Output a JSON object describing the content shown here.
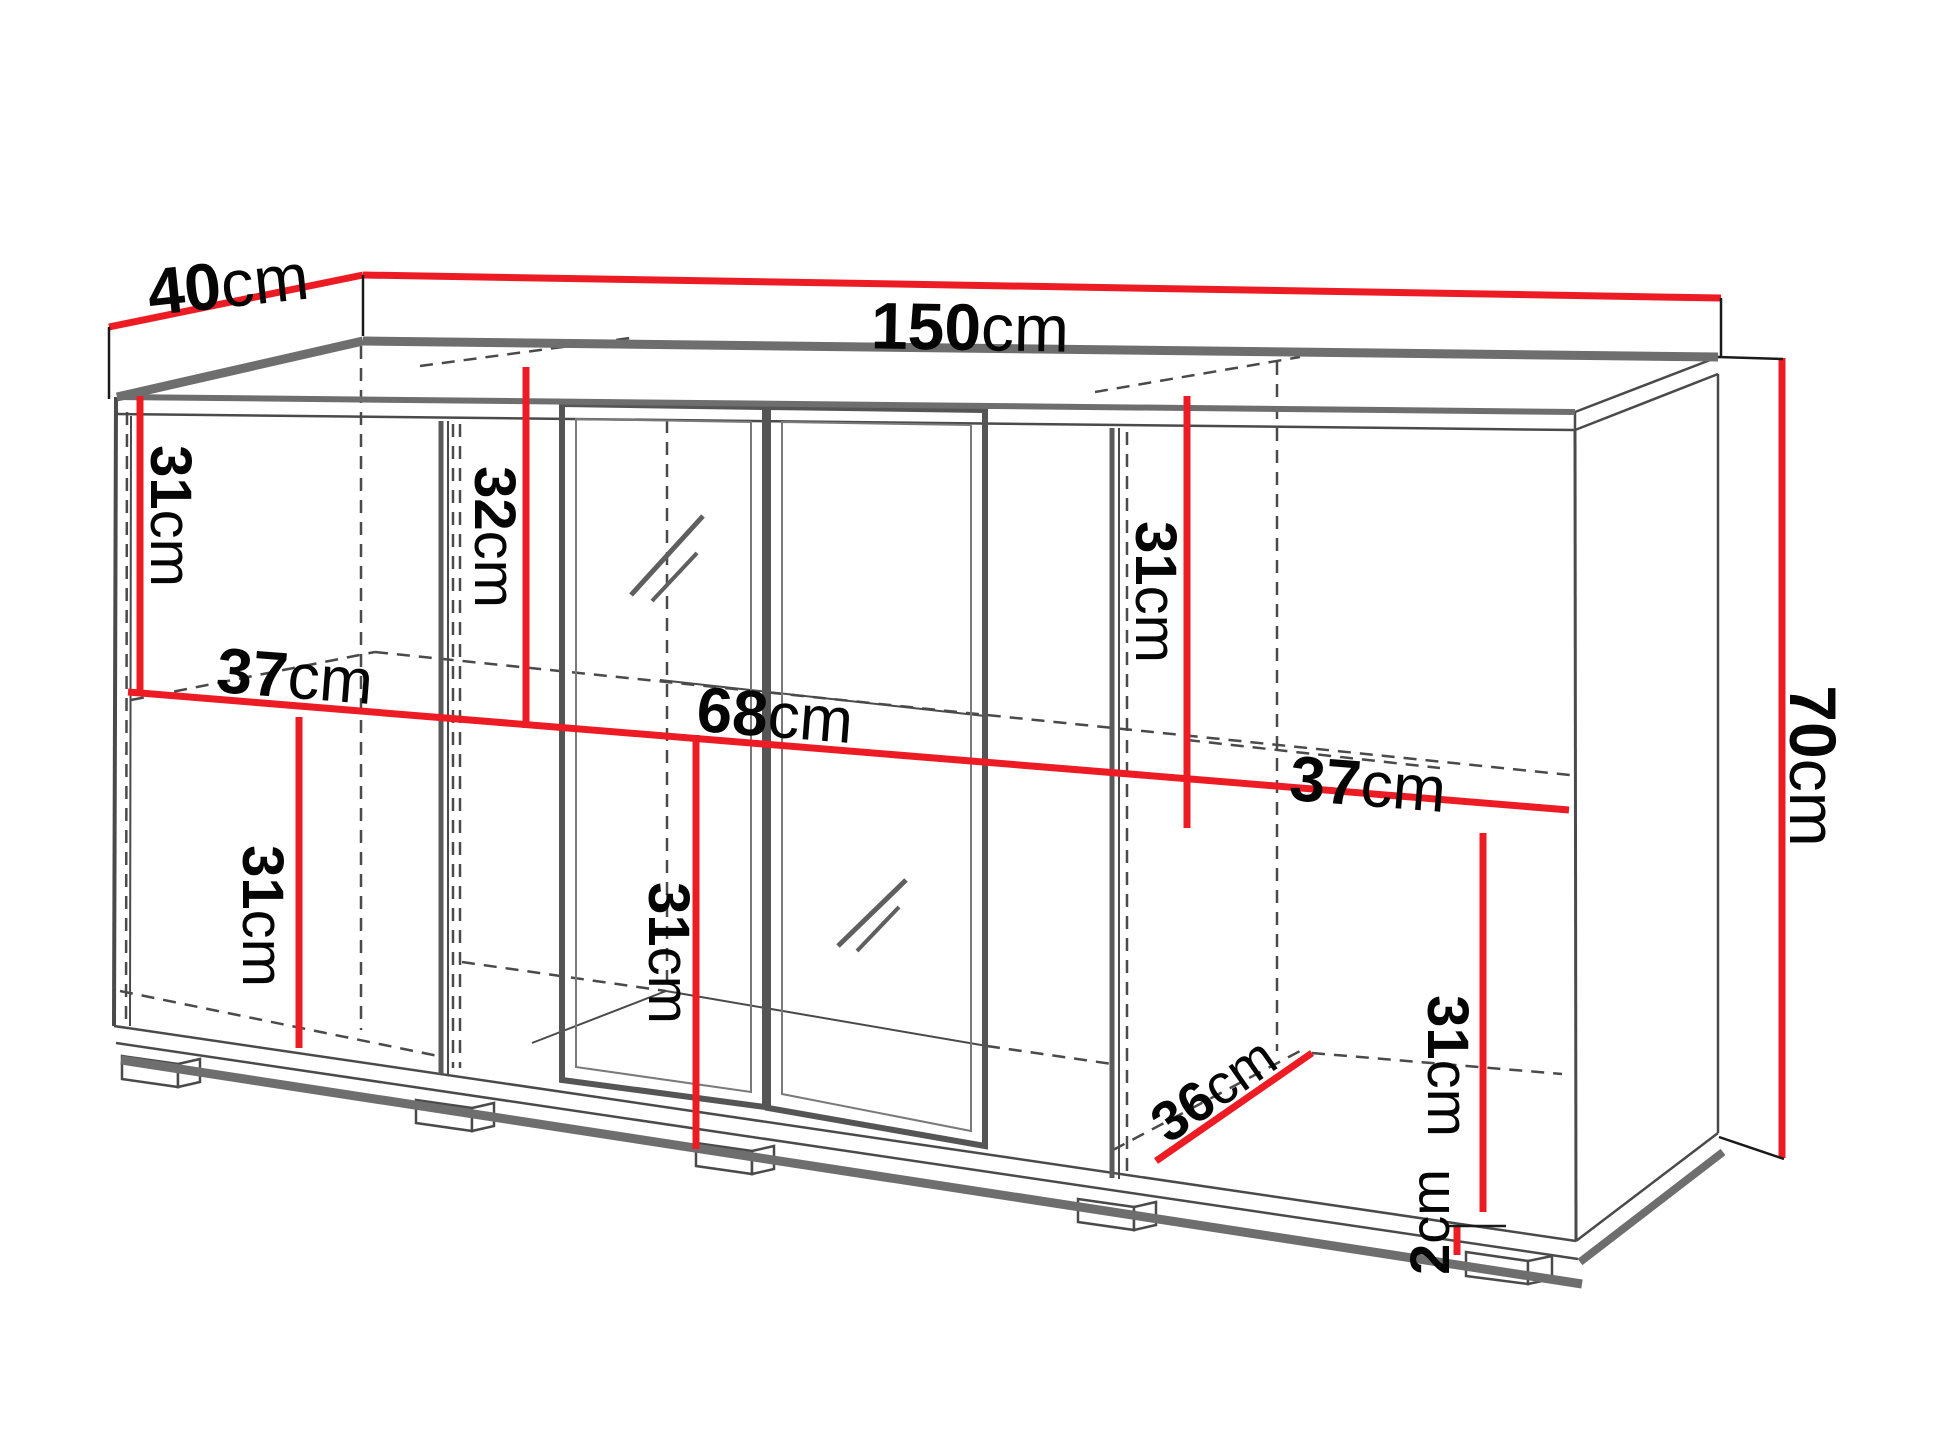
{
  "diagram": {
    "type": "furniture-dimension-drawing",
    "subject": "sideboard-with-glass-doors",
    "colors": {
      "dimension": "#ed1c24",
      "outline_thin": "#4a4a4a",
      "outline_thick": "#6e6e6e",
      "extension": "#1a1a1a",
      "text": "#050505",
      "background": "#ffffff"
    },
    "labels": {
      "depth": {
        "num": "40",
        "unit": "cm"
      },
      "width": {
        "num": "150",
        "unit": "cm"
      },
      "height": {
        "num": "70",
        "unit": "cm"
      },
      "top_left": {
        "num": "31",
        "unit": "cm"
      },
      "top_middle": {
        "num": "32",
        "unit": "cm"
      },
      "top_right": {
        "num": "31",
        "unit": "cm"
      },
      "shelf_left": {
        "num": "37",
        "unit": "cm"
      },
      "shelf_center": {
        "num": "68",
        "unit": "cm"
      },
      "shelf_right": {
        "num": "37",
        "unit": "cm"
      },
      "bottom_left": {
        "num": "31",
        "unit": "cm"
      },
      "bottom_center": {
        "num": "31",
        "unit": "cm"
      },
      "bottom_right": {
        "num": "31",
        "unit": "cm"
      },
      "floor_depth": {
        "num": "36",
        "unit": "cm"
      },
      "plinth_height": {
        "num": "2",
        "unit": "cm"
      }
    }
  }
}
